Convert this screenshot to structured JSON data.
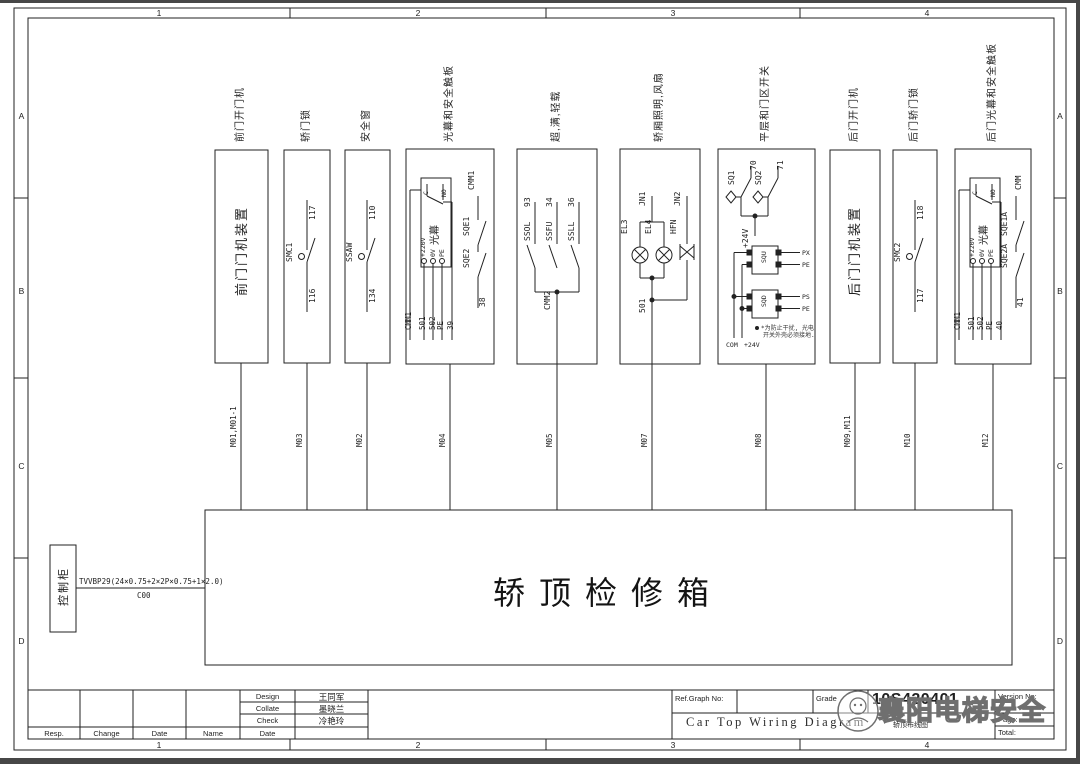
{
  "frame": {
    "cols": [
      "1",
      "2",
      "3",
      "4"
    ],
    "rows": [
      "A",
      "B",
      "C",
      "D"
    ]
  },
  "blocks": [
    {
      "title": "前门开门机",
      "device": "前门门机装置"
    },
    {
      "title": "轿门锁",
      "sw": "SMC1",
      "top": "117",
      "bottom": "116"
    },
    {
      "title": "安全窗",
      "sw": "SSAW",
      "top": "110",
      "bottom": "134"
    },
    {
      "title": "光幕和安全触板",
      "unit": "光幕",
      "t_c": "C",
      "t_no": "NO",
      "t_220": "+220V",
      "t_0": "0V",
      "t_pe": "PE",
      "lead0": "CMM1",
      "lead1": "501",
      "lead2": "502",
      "lead3": "PE",
      "lead4": "39",
      "sw_top": "CMM1",
      "sw1": "SQE1",
      "sw2": "SQE2",
      "sw_bottom": "38"
    },
    {
      "title": "超,满,轻载",
      "sw1": "SSOL",
      "w1": "93",
      "sw2": "SSFU",
      "w2": "34",
      "sw3": "SSLL",
      "w3": "36",
      "common": "CMM2"
    },
    {
      "title": "轿厢照明,风扇",
      "lamp1": "EL3",
      "lamp2": "EL4",
      "fan": "HFN",
      "j1": "JN1",
      "j2": "JN2",
      "bottom": "501"
    },
    {
      "title": "平层和门区开关",
      "sw1": "SQ1",
      "w1": "70",
      "sw2": "SQ2",
      "w2": "71",
      "common": "+24V",
      "s1": "SQU",
      "s1a": "PX",
      "s1b": "PE",
      "s2": "SQD",
      "s2a": "PS",
      "s2b": "PE",
      "bus1": "COM",
      "bus2": "+24V",
      "note1": "*为防止干扰, 光电",
      "note2": "开关外壳必须接地."
    },
    {
      "title": "后门开门机",
      "device": "后门门机装置"
    },
    {
      "title": "后门轿门锁",
      "sw": "SMC2",
      "top": "118",
      "bottom": "117"
    },
    {
      "title": "后门光幕和安全触板",
      "unit": "光幕",
      "t_c": "C",
      "t_no": "NO",
      "t_220": "+220V",
      "t_0": "0V",
      "t_pe": "PE",
      "lead0": "CMM1",
      "lead1": "501",
      "lead2": "502",
      "lead3": "PE",
      "lead4": "40",
      "sw_top": "CMM",
      "sw1": "SQE1A",
      "sw2": "SQE2A",
      "sw_bottom": "41"
    }
  ],
  "wires": [
    "M01,M01-1",
    "M03",
    "M02",
    "M04",
    "M05",
    "M07",
    "M08",
    "M09,M11",
    "M10",
    "M12"
  ],
  "main_box": {
    "label": "轿顶检修箱"
  },
  "cabinet": {
    "label": "控制柜"
  },
  "cable": {
    "spec": "TVVBP29(24×0.75+2×2P×0.75+1×2.0)",
    "code": "C00"
  },
  "titleblock": {
    "resp": "Resp.",
    "change": "Change",
    "date": "Date",
    "name": "Name",
    "rows": [
      {
        "label": "Design",
        "value": "王同军"
      },
      {
        "label": "Collate",
        "value": "墨晓兰"
      },
      {
        "label": "Check",
        "value": "冷艳玲"
      },
      {
        "label": "Date",
        "value": ""
      }
    ],
    "ref_graph": "Ref.Graph No:",
    "grade": "Grade",
    "drawing_no": "10S420401",
    "version": "Version No:",
    "page": "Page:",
    "total": "Total:",
    "title_en": "Car Top Wiring Diagram",
    "title_cn": "轿顶布线图"
  },
  "watermark": {
    "text": "襄阳电梯安全"
  }
}
